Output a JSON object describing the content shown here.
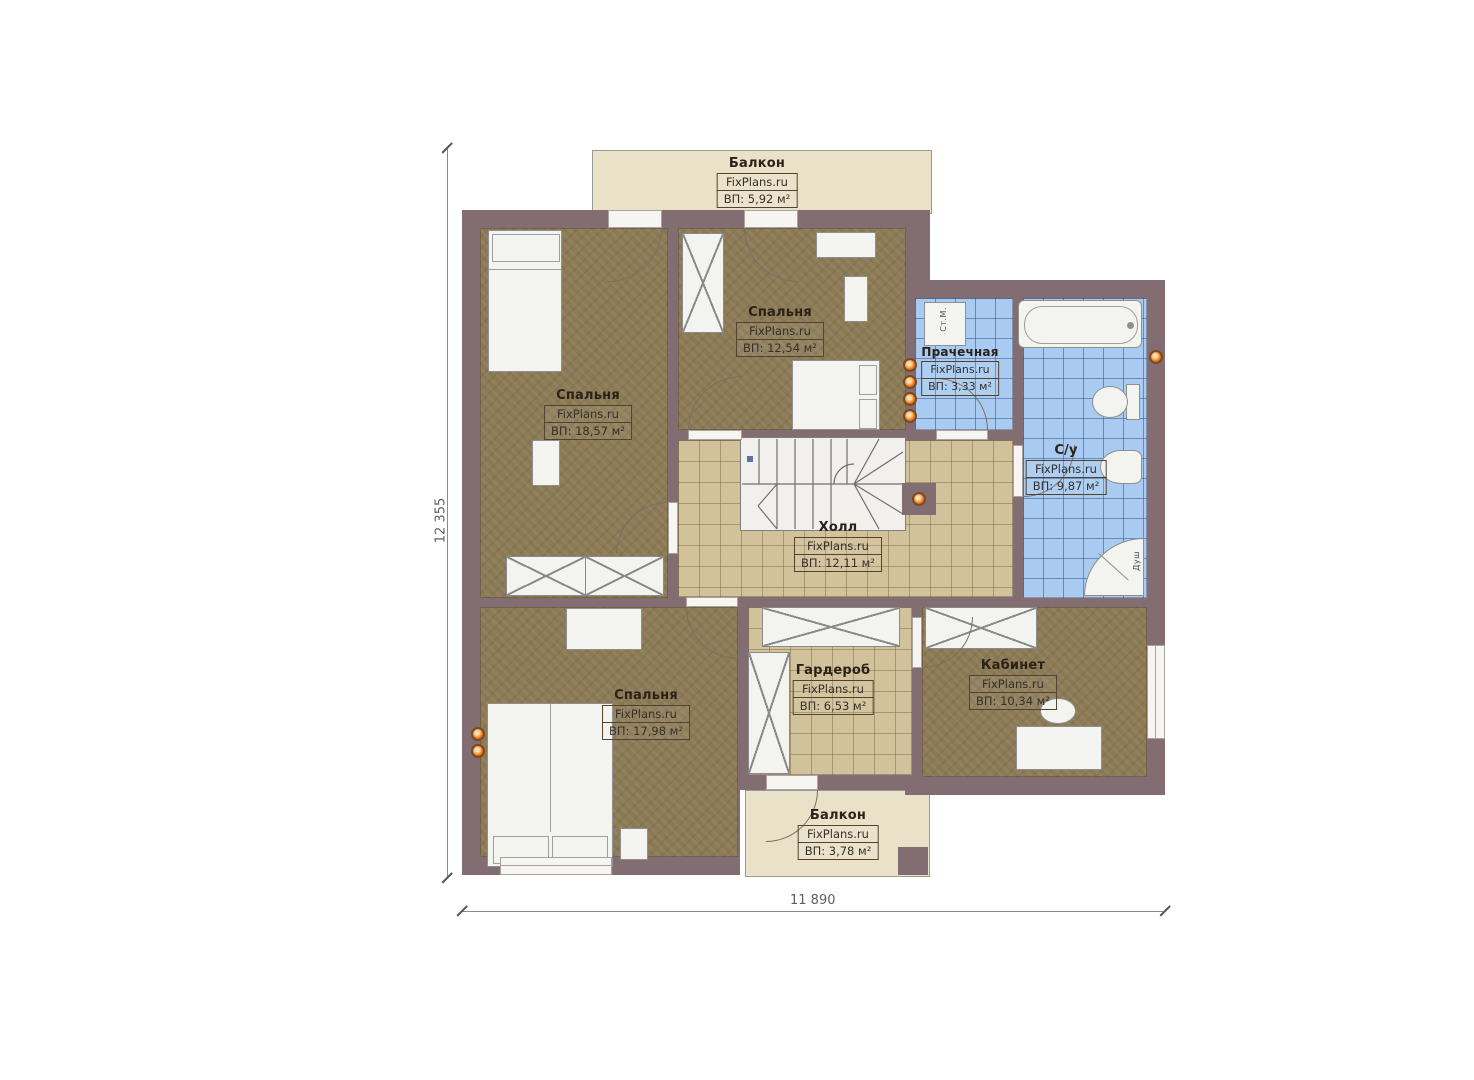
{
  "brand": "FixPlans.ru",
  "plan": {
    "dimensions": {
      "height_label": "12 355",
      "width_label": "11 890"
    }
  },
  "rooms": [
    {
      "name": "Балкон",
      "area": "ВП: 5,92 м²"
    },
    {
      "name": "Спальня",
      "area": "ВП: 12,54 м²"
    },
    {
      "name": "Спальня",
      "area": "ВП: 18,57 м²"
    },
    {
      "name": "Прачечная",
      "area": "ВП: 3,33 м²"
    },
    {
      "name": "С/у",
      "area": "ВП: 9,87 м²"
    },
    {
      "name": "Холл",
      "area": "ВП: 12,11 м²"
    },
    {
      "name": "Спальня",
      "area": "ВП: 17,98 м²"
    },
    {
      "name": "Гардероб",
      "area": "ВП: 6,53 м²"
    },
    {
      "name": "Кабинет",
      "area": "ВП: 10,34 м²"
    },
    {
      "name": "Балкон",
      "area": "ВП: 3,78 м²"
    }
  ],
  "fixtures": {
    "washer": "Ст.М.",
    "shower": "Душ"
  },
  "colors": {
    "wall": "#826d72",
    "floor_wood": "#8c7a55",
    "floor_tile": "#d2c29b",
    "floor_bath": "#a9cbf2",
    "balcony": "#eae1c9",
    "marker": "#e87818"
  }
}
